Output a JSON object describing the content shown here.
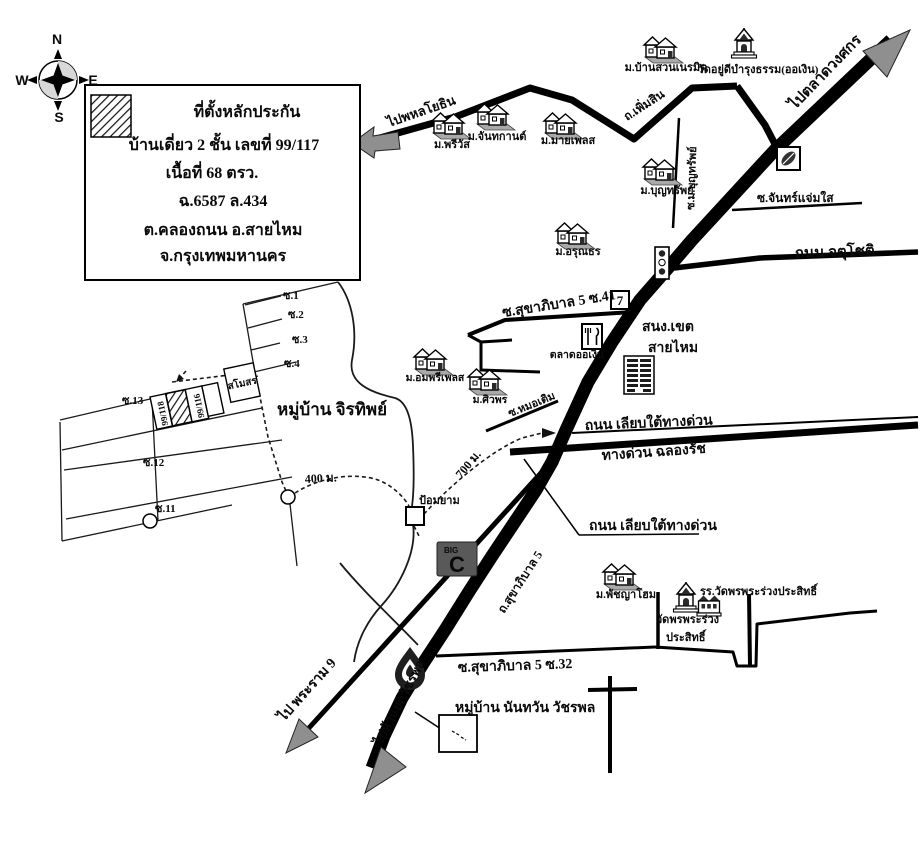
{
  "compass": {
    "n": "N",
    "e": "E",
    "s": "S",
    "w": "W"
  },
  "legend": {
    "title": "ที่ตั้งหลักประกัน",
    "house_line": "บ้านเดี่ยว 2 ชั้น เลขที่ 99/117",
    "area_line": "เนื้อที่ 68 ตรว.",
    "deed_line": "ฉ.6587 ล.434",
    "district_line": "ต.คลองถนน อ.สายไหม",
    "province_line": "จ.กรุงเทพมหานคร"
  },
  "roads": {
    "to_phahonyothin": "ไปพหลโยธิน",
    "phoem_sin": "ถ.เพิ่มสิน",
    "to_talat_wongsakon": "ไปตลาดวงศกร",
    "soi_mu_bunsap": "ซ.ม.บุญทรัพย์",
    "soi_chan_chaem_sai": "ซ.จันทร์แจ่มใส",
    "chatuchot": "ถนน จตุโชติ",
    "soi41": "ซ.สุขาภิบาล 5 ซ.41",
    "soi_mo_toem": "ซ.หมอเติม",
    "liap_tai_1": "ถนน เลียบใต้ทางด่วน",
    "expressway": "ทางด่วน ฉลองรัช",
    "liap_tai_2": "ถนน เลียบใต้ทางด่วน",
    "sukhaphiban5": "ถ.สุขาภิบาล 5",
    "soi32": "ซ.สุขาภิบาล 5 ซ.32",
    "to_rama9": "ไป พระราม 9",
    "to_watcharaphon": "ไปห้าแยกวัชรพล"
  },
  "places": {
    "previs": "ม.พรีวัส",
    "chanthakan": "ม.จันทกานต์",
    "myplace": "ม.มายเพลส",
    "bansuan_neramit": "ม.บ้านสวนเนรมิต",
    "wat_yudi": "วัดอยู่ดีบำรุงธรรม(ออเงิน)",
    "bunsap": "ม.บุญทรัพย์",
    "arunthon": "ม.อรุณธร",
    "talat_o_ngoen": "ตลาดออเงิน",
    "district_office_1": "สนง.เขต",
    "district_office_2": "สายไหม",
    "amphri_place": "ม.อมพรีเพลส",
    "siwaphon": "ม.ศิวพร",
    "guard_post": "ป้อมยาม",
    "phatchaya_home": "ม.พัชญาโฮม",
    "school": "รร.วัดพรพระร่วงประสิทธิ์",
    "wat_line1": "วัดพรพระร่วง",
    "wat_line2": "ประสิทธิ์",
    "clubhouse": "สโมสร"
  },
  "villages": {
    "jirathip": "หมู่บ้าน จิรทิพย์",
    "nanthawan": "หมู่บ้าน นันทวัน วัชรพล"
  },
  "plots": {
    "left": "99/118",
    "right": "99/116"
  },
  "sois": {
    "s1": "ซ.1",
    "s2": "ซ.2",
    "s3": "ซ.3",
    "s4": "ซ.4",
    "s11": "ซ.11",
    "s12": "ซ.12",
    "s13": "ซ.13"
  },
  "distances": {
    "d400": "400 ม.",
    "d700": "700 ม."
  },
  "logos": {
    "seven": "7",
    "bigc_small": "BIG",
    "bigc_big": "C"
  },
  "colors": {
    "line": "#000000",
    "arrow_gray": "#8f8f8f",
    "bigc_bg": "#595959"
  }
}
